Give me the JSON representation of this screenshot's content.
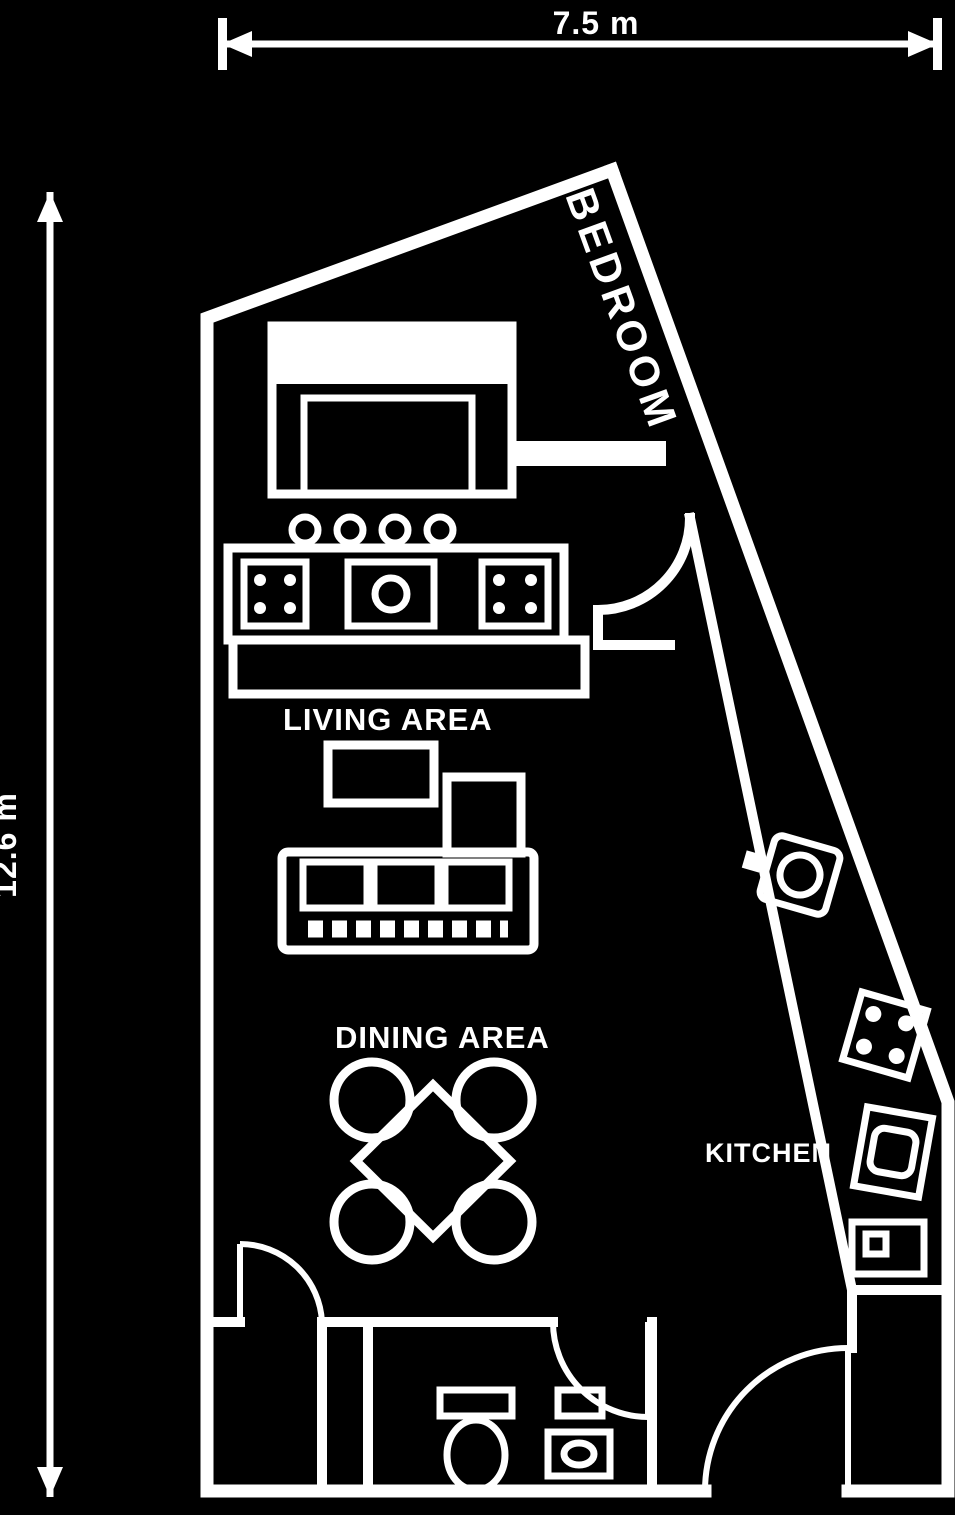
{
  "colors": {
    "background": "#000000",
    "line": "#ffffff"
  },
  "dimensions": {
    "width_label": "7.5 m",
    "height_label": "12.6 m"
  },
  "rooms": {
    "bedroom_label": "BEDROOM",
    "living_label": "LIVING AREA",
    "dining_label": "DINING AREA",
    "kitchen_label": "KITCHEN"
  },
  "furniture": [
    "bed",
    "kitchen-counter",
    "sideboard",
    "coffee-table",
    "ottoman",
    "sofa",
    "dining-table",
    "dining-chairs",
    "sink",
    "hob",
    "oven",
    "washer",
    "toilet",
    "washbasin",
    "entrance-door",
    "closet-door",
    "bath-door"
  ]
}
